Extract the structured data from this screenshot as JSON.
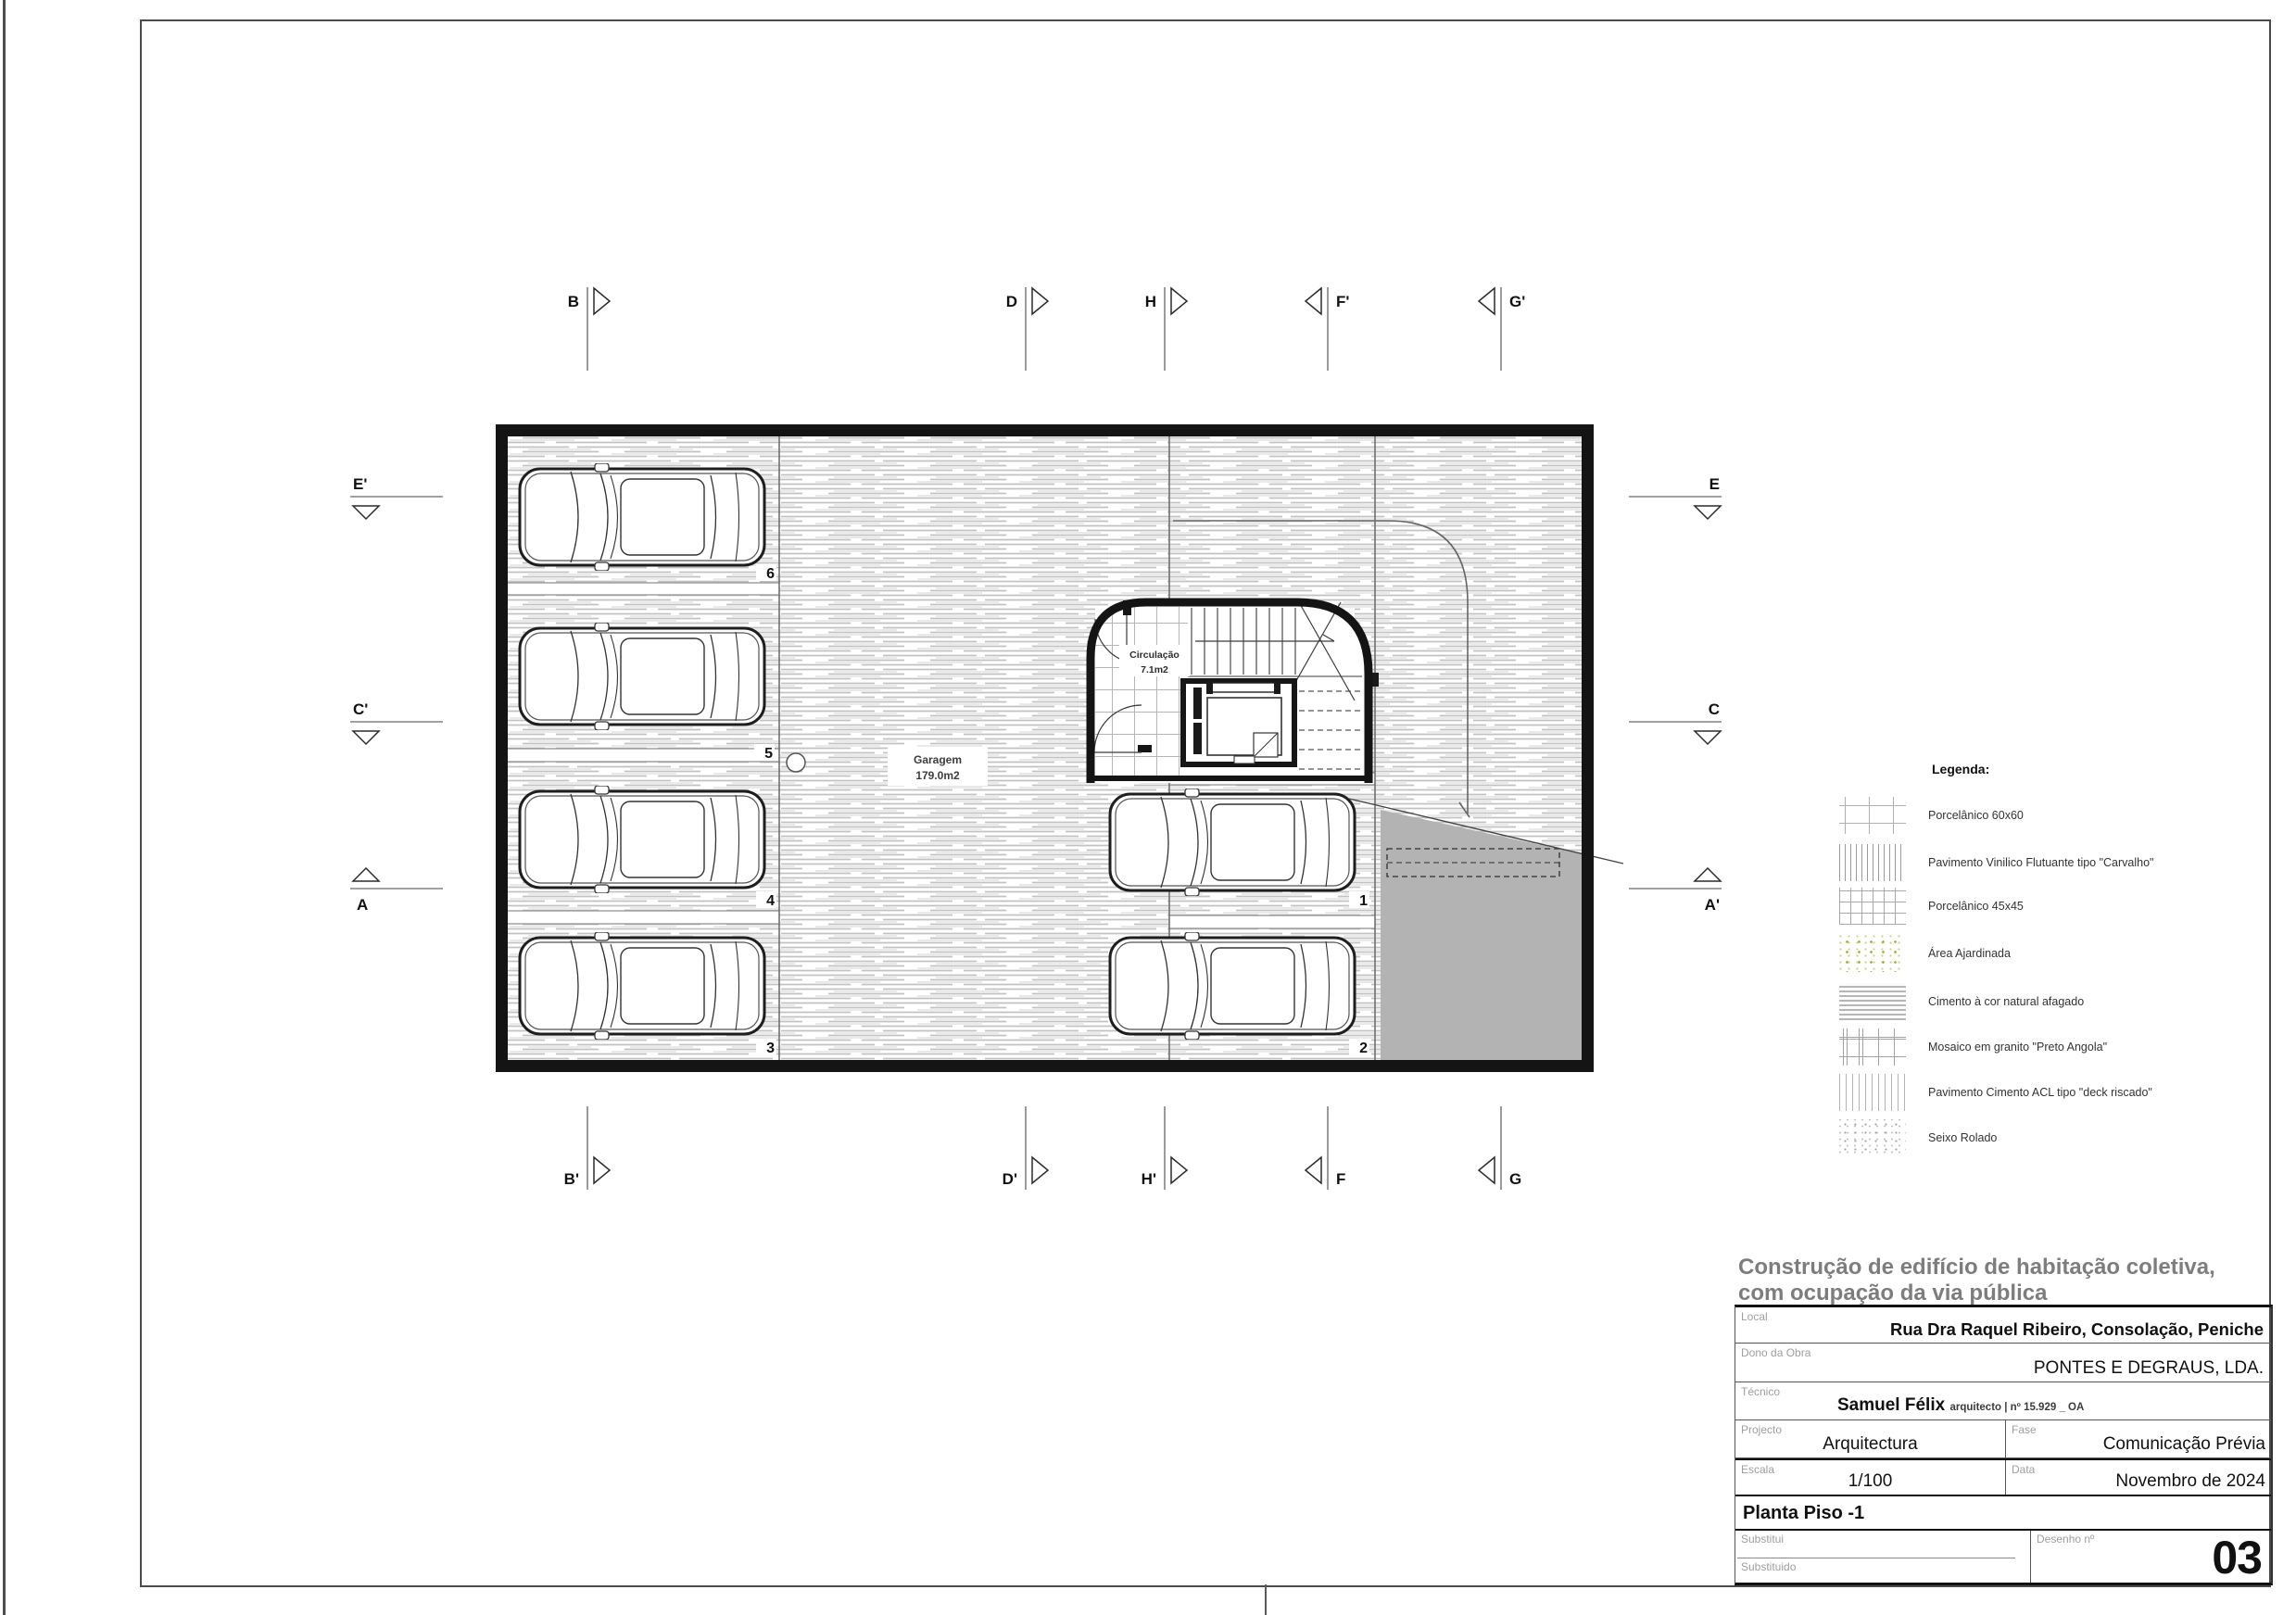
{
  "plan": {
    "garage": {
      "label": "Garagem",
      "area": "179.0m2"
    },
    "circulation": {
      "label": "Circulação",
      "area": "7.1m2"
    },
    "stalls": [
      "1",
      "2",
      "3",
      "4",
      "5",
      "6"
    ],
    "markers": {
      "top": [
        "B",
        "D",
        "H",
        "F'",
        "G'"
      ],
      "bottom": [
        "B'",
        "D'",
        "H'",
        "F",
        "G"
      ],
      "left": [
        "E'",
        "C'",
        "A"
      ],
      "right": [
        "E",
        "C",
        "A'"
      ]
    }
  },
  "legend": {
    "heading": "Legenda:",
    "items": [
      {
        "label": "Porcelânico 60x60",
        "pattern": "grid-60x60"
      },
      {
        "label": "Pavimento Vinilico Flutuante tipo \"Carvalho\"",
        "pattern": "vertical-lines-dense"
      },
      {
        "label": "Porcelânico 45x45",
        "pattern": "grid-45x45"
      },
      {
        "label": "Área Ajardinada",
        "pattern": "green-speckle"
      },
      {
        "label": "Cimento à cor natural afagado",
        "pattern": "horizontal-streaks"
      },
      {
        "label": "Mosaico em granito \"Preto Angola\"",
        "pattern": "brick"
      },
      {
        "label": "Pavimento Cimento ACL tipo \"deck riscado\"",
        "pattern": "vertical-lines-light"
      },
      {
        "label": "Seixo Rolado",
        "pattern": "gray-speckle"
      }
    ]
  },
  "title_block": {
    "project_title_line1": "Construção de edifício de habitação coletiva,",
    "project_title_line2": "com ocupação da via pública",
    "local": {
      "label": "Local",
      "value": "Rua Dra Raquel Ribeiro, Consolação, Peniche"
    },
    "dono": {
      "label": "Dono da Obra",
      "value": "PONTES E DEGRAUS, LDA."
    },
    "tecnico": {
      "label": "Técnico",
      "name": "Samuel Félix",
      "credentials": "arquitecto | nº 15.929 _ OA"
    },
    "projecto": {
      "label": "Projecto",
      "value": "Arquitectura"
    },
    "fase": {
      "label": "Fase",
      "value": "Comunicação Prévia"
    },
    "escala": {
      "label": "Escala",
      "value": "1/100"
    },
    "data": {
      "label": "Data",
      "value": "Novembro de 2024"
    },
    "drawing_name": "Planta Piso -1",
    "substitui_label": "Substitui",
    "substituido_label": "Substituido",
    "desenho": {
      "label": "Desenho nº",
      "number": "03"
    }
  },
  "colors": {
    "ramp_gray": "#b3b3b3",
    "hatch_line": "#c2c2c2",
    "garden_green": "#9cba3c",
    "wall": "#141414"
  }
}
